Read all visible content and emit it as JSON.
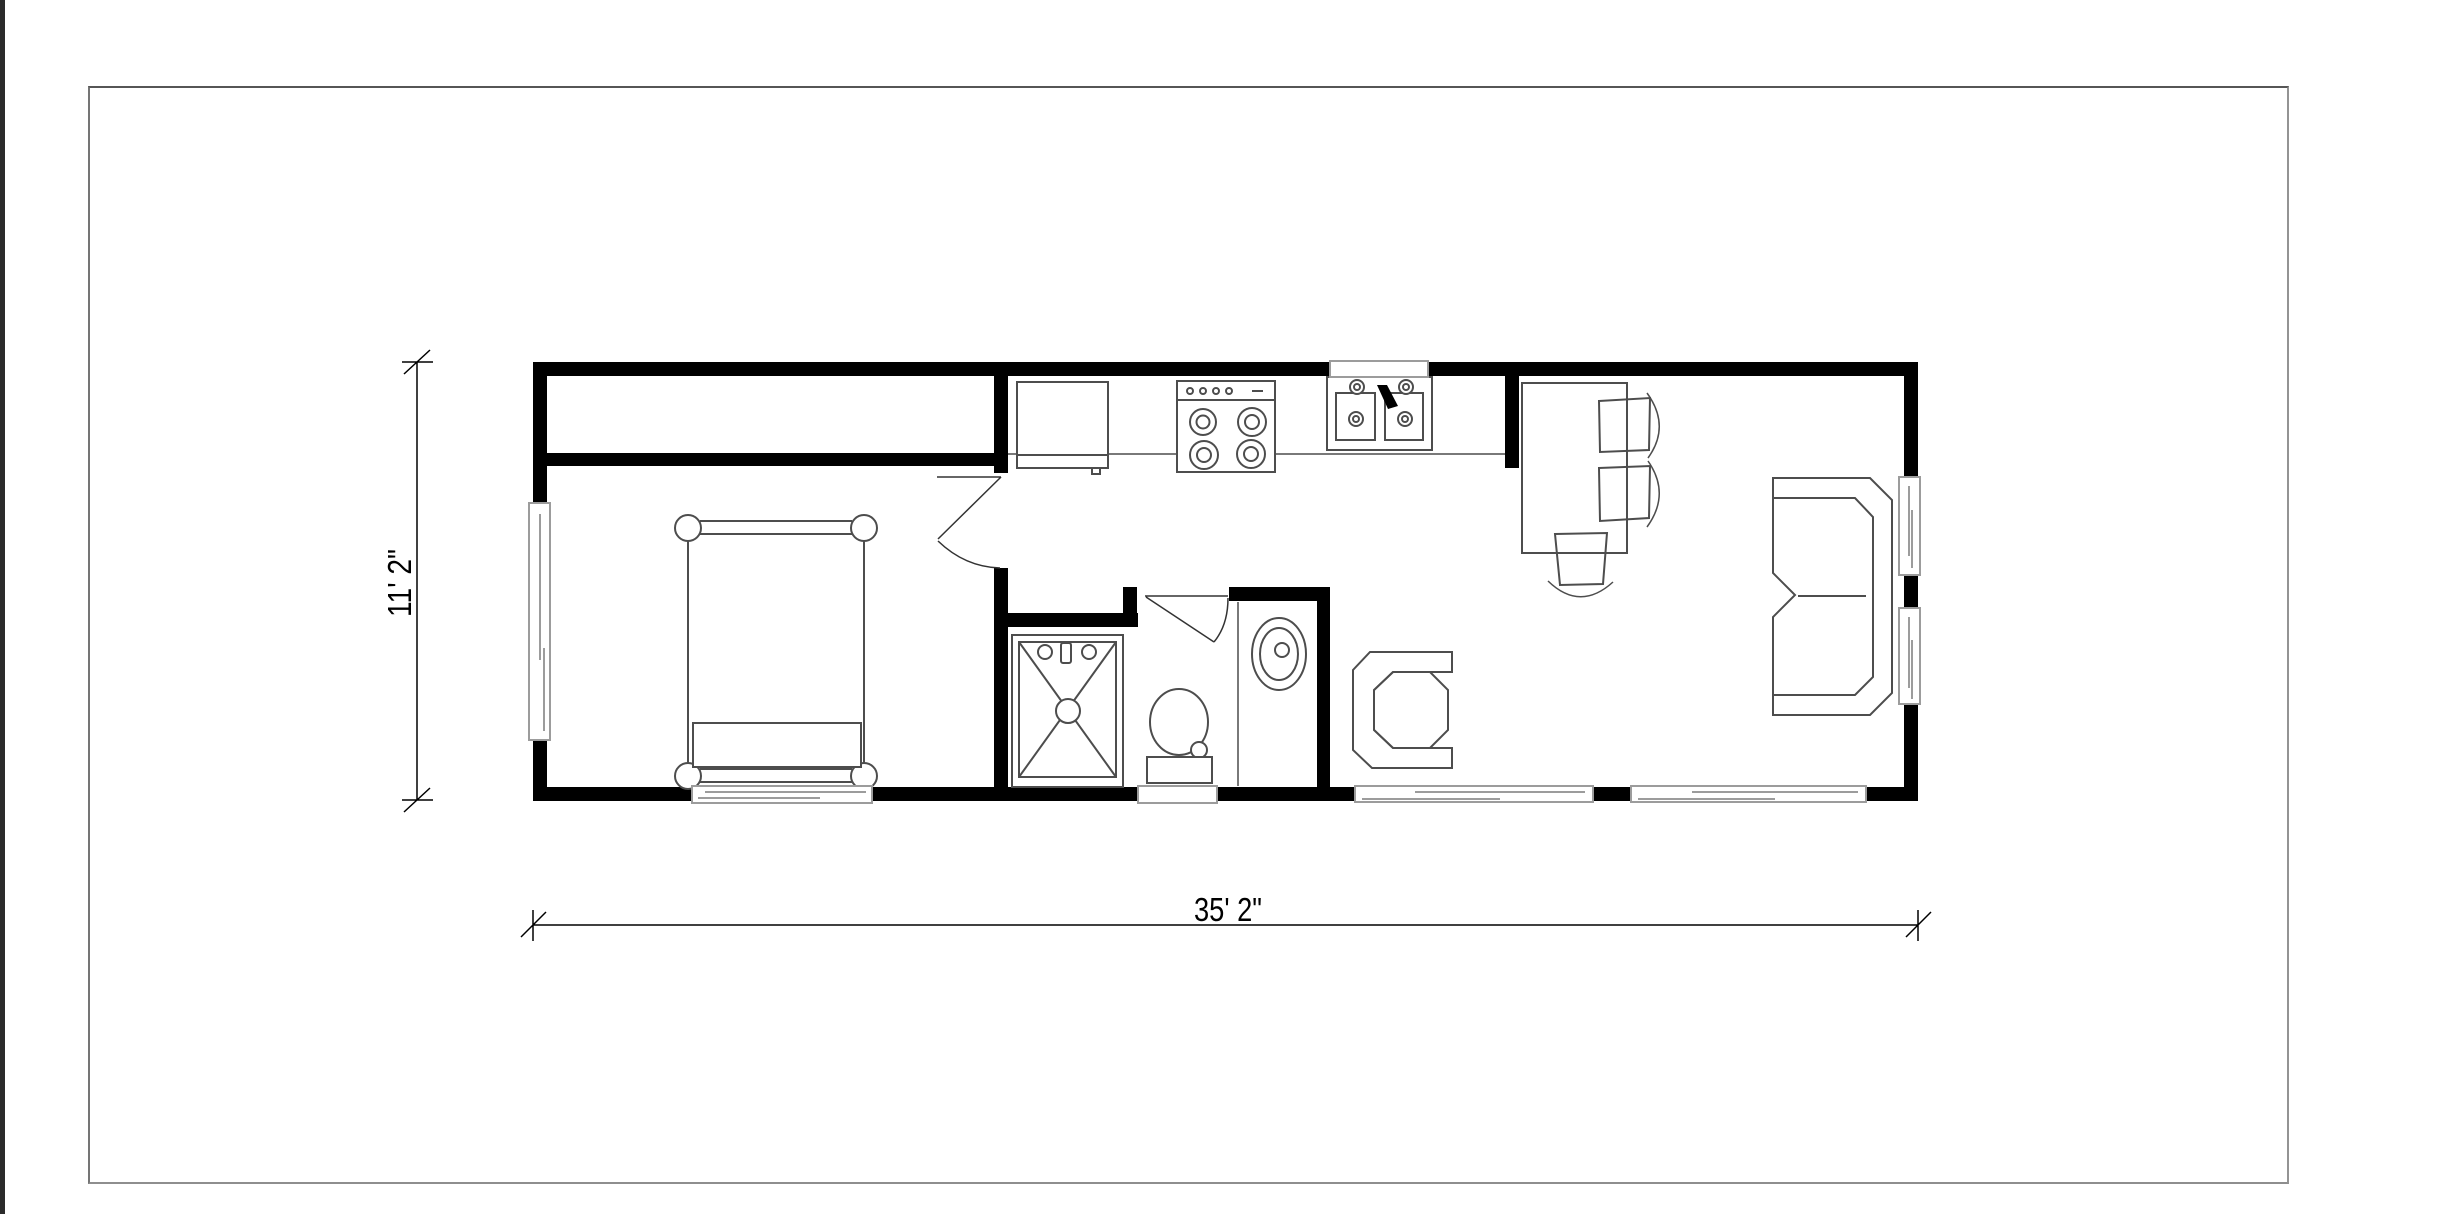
{
  "drawing": {
    "type": "floor-plan",
    "dimensions": {
      "width_label": "35' 2\"",
      "height_label": "11' 2\""
    },
    "fixtures": [
      "closet",
      "bed",
      "bedroom-door",
      "bathroom-door",
      "shower",
      "toilet",
      "bathroom-sink",
      "refrigerator",
      "stove",
      "kitchen-sink",
      "kitchen-counter",
      "dining-table",
      "dining-chair",
      "dining-chair",
      "dining-chair",
      "armchair",
      "sofa",
      "window",
      "window",
      "window",
      "window",
      "window",
      "window",
      "window",
      "window"
    ]
  },
  "colors": {
    "wall": "#000000",
    "furniture_line": "#4d4d4d",
    "window_line": "#9c9c9c",
    "dimension_text": "#000000",
    "sheet_border": "#8e8e8e",
    "edge_strip": "#2b2b2b",
    "background": "#ffffff"
  }
}
